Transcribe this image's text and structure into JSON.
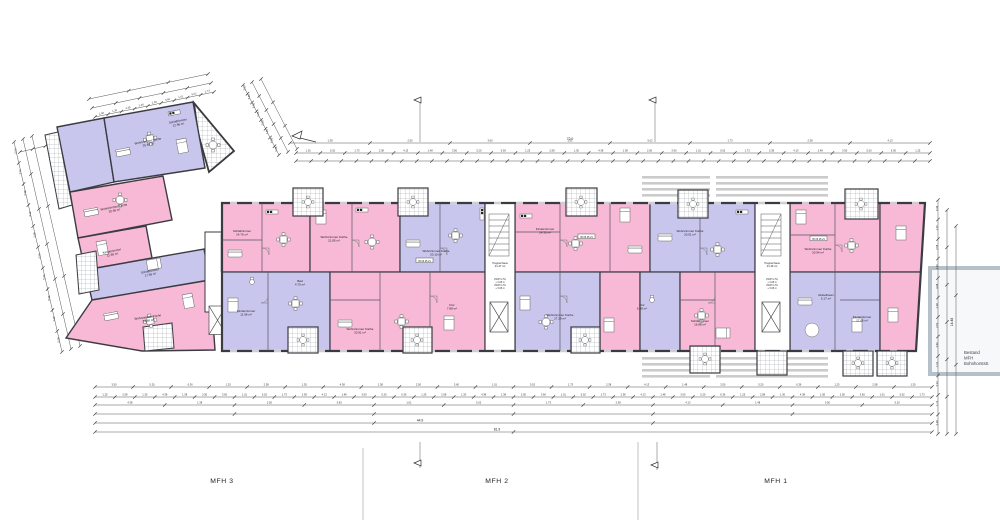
{
  "buildings": {
    "mfh3": "MFH 3",
    "mfh2": "MFH 2",
    "mfh1": "MFH 1"
  },
  "existing_building": {
    "line1": "Bestand",
    "line2": "MFH",
    "line3": "Bohnhorststr."
  },
  "colors": {
    "apartment_pink": "#f7b9d6",
    "apartment_lavender": "#c9c6ee",
    "wall": "#3b3b42",
    "balcony_hatch": "#9aa0a4",
    "existing_gray": "#b6c0c8",
    "dimension": "#444444"
  },
  "dims": {
    "top_total": "72.0",
    "bottom_total_1": "44.9",
    "bottom_total_2": "81.9",
    "right_total": "14.48",
    "samples": [
      "1.38",
      "2.50",
      "3.60",
      "1.01",
      "5.02",
      "1.73",
      "2.38",
      "4.13",
      "1.48",
      "3.50",
      "5.20",
      "6.36",
      "1.25",
      "2.58",
      "1.30",
      "4.38"
    ]
  },
  "cores": [
    {
      "label": "Treppenhaus",
      "area": "21.47 m²",
      "notes": [
        "2WKT-LTG",
        "+ 3,08 m",
        "2WKT-LTG",
        "+ 3,08 m"
      ]
    },
    {
      "label": "Treppenhaus",
      "area": "21.46 m²",
      "notes": [
        "2WKT-LTG",
        "+ 3,08 m",
        "2WKT-LTG",
        "+ 3,08 m"
      ]
    }
  ],
  "chips": {
    "c1": "05 06 05 21",
    "c2": "05 06 05 21",
    "c3": "05 06 05 21"
  },
  "rooms": [
    {
      "label": "Wohnzimmer Küche",
      "area": "25.88 m²"
    },
    {
      "label": "Schlafzimmer",
      "area": "12.96 m²"
    },
    {
      "label": "Wohnzimmer Küche",
      "area": "20.95 m²"
    },
    {
      "label": "Kinderzimmer",
      "area": "11.98 m²"
    },
    {
      "label": "Schlafzimmer",
      "area": "17.56 m²"
    },
    {
      "label": "Wohnzimmer Küche",
      "area": "24.88 m²"
    },
    {
      "label": "Schlafzimmer",
      "area": "14.76 m²"
    },
    {
      "label": "Wohnzimmer Küche",
      "area": "21.85 m²"
    },
    {
      "label": "Kinderzimmer",
      "area": "11.98 m²"
    },
    {
      "label": "Wohnzimmer Küche",
      "area": "20.91 m²"
    },
    {
      "label": "Wohnzimmer Küche",
      "area": "20.10 m²"
    },
    {
      "label": "Flur",
      "area": "7.88 m²"
    },
    {
      "label": "Kinderzimmer",
      "area": "14.30 m²"
    },
    {
      "label": "Wohnzimmer Küche",
      "area": "27.29 m²"
    },
    {
      "label": "Wohnzimmer Küche",
      "area": "20.01 m²"
    },
    {
      "label": "Schlafzimmer",
      "area": "16.88 m²"
    },
    {
      "label": "Wohnzimmer Küche",
      "area": "20.94 m²"
    },
    {
      "label": "Abstellraum",
      "area": "5.17 m²"
    },
    {
      "label": "Kinderzimmer",
      "area": "17.06 m²"
    },
    {
      "label": "Bad",
      "area": "4.70 m²"
    },
    {
      "label": "Flur",
      "area": "6.98 m²"
    }
  ]
}
